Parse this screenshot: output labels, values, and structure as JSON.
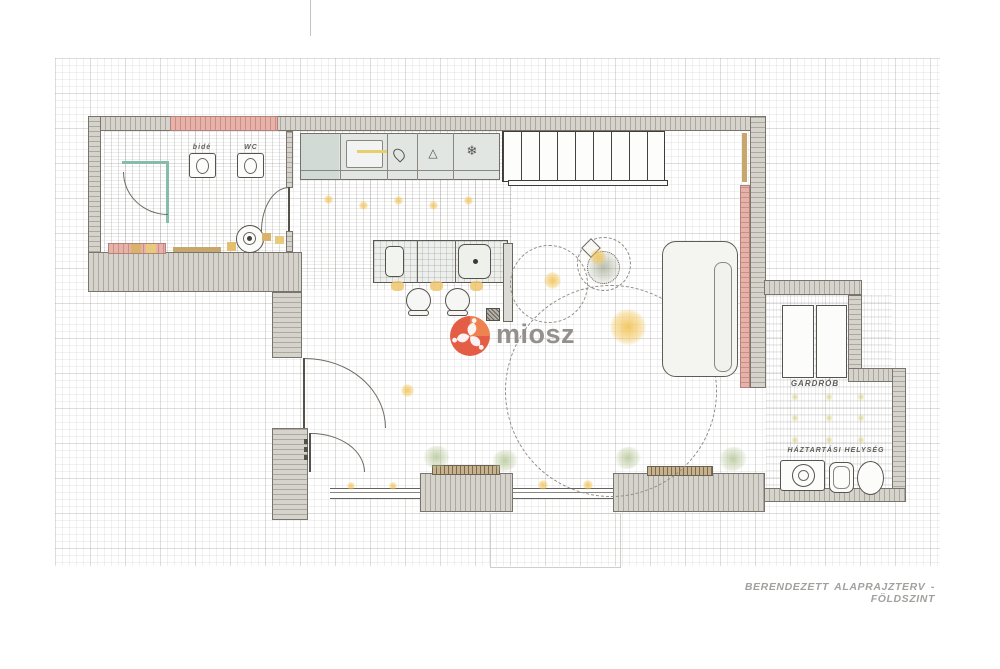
{
  "meta": {
    "caption": "BERENDEZETT ALAPRAJZTERV - FÖLDSZINT"
  },
  "logo": {
    "text": "miosz"
  },
  "rooms": {
    "bathroom": {
      "bide_label": "bidé",
      "wc_label": "WC"
    },
    "wardrobe_room": {
      "label": "GARDRÓB"
    },
    "utility_room": {
      "label": "HÁZTARTÁSI HELYSÉG"
    }
  },
  "icons": {
    "snowflake": "❄",
    "hood": "△"
  },
  "colors": {
    "wall_gray": "#d6d3cc",
    "wall_pink": "#e6b2a9",
    "glass_teal": "#86bcab",
    "accent_yellow": "#f0c25a",
    "shelf_tan": "#c7a76b",
    "logo_red": "#e15238",
    "caption_gray": "#a3a19e"
  }
}
